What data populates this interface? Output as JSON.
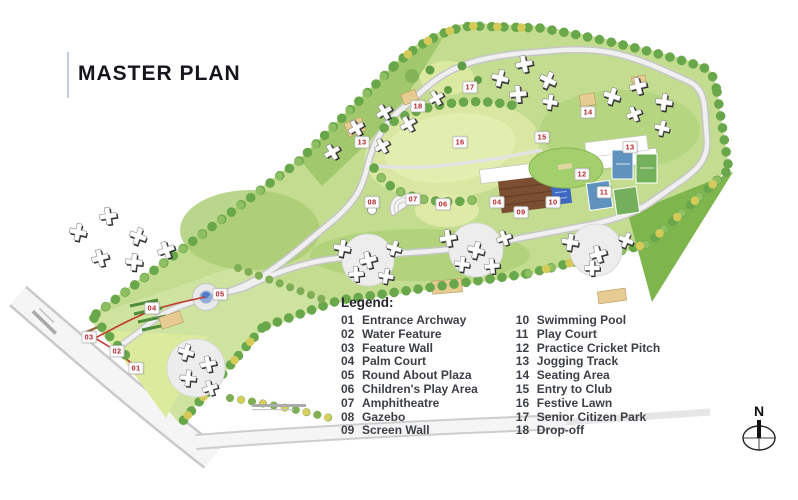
{
  "title": "MASTER PLAN",
  "legend": {
    "heading": "Legend:",
    "items": [
      {
        "num": "01",
        "label": "Entrance Archway"
      },
      {
        "num": "02",
        "label": "Water Feature"
      },
      {
        "num": "03",
        "label": "Feature Wall"
      },
      {
        "num": "04",
        "label": "Palm Court"
      },
      {
        "num": "05",
        "label": "Round About Plaza"
      },
      {
        "num": "06",
        "label": "Children's Play Area"
      },
      {
        "num": "07",
        "label": "Amphitheatre"
      },
      {
        "num": "08",
        "label": "Gazebo"
      },
      {
        "num": "09",
        "label": "Screen Wall"
      },
      {
        "num": "10",
        "label": "Swimming Pool"
      },
      {
        "num": "11",
        "label": "Play Court"
      },
      {
        "num": "12",
        "label": "Practice Cricket Pitch"
      },
      {
        "num": "13",
        "label": "Jogging Track"
      },
      {
        "num": "14",
        "label": "Seating Area"
      },
      {
        "num": "15",
        "label": "Entry to Club"
      },
      {
        "num": "16",
        "label": "Festive Lawn"
      },
      {
        "num": "17",
        "label": "Senior Citizen Park"
      },
      {
        "num": "18",
        "label": "Drop-off"
      }
    ]
  },
  "map": {
    "markers": [
      {
        "label": "01"
      },
      {
        "label": "02"
      },
      {
        "label": "03"
      },
      {
        "label": "04"
      },
      {
        "label": "05"
      },
      {
        "label": "06"
      },
      {
        "label": "07"
      },
      {
        "label": "08"
      },
      {
        "label": "09"
      },
      {
        "label": "10"
      },
      {
        "label": "11"
      },
      {
        "label": "12"
      },
      {
        "label": "13"
      },
      {
        "label": "14"
      },
      {
        "label": "15"
      },
      {
        "label": "16"
      },
      {
        "label": "17"
      },
      {
        "label": "18"
      },
      {
        "label": "13"
      },
      {
        "label": "04"
      }
    ]
  },
  "compass": {
    "north_label": "N"
  },
  "colors": {
    "marker_red": "#b3262c",
    "site_green": "#c3dc90",
    "lawn_yellow_green": "#dce9a6",
    "dark_lawn_green": "#7fb54d",
    "pool_blue": "#3f68c0",
    "road_grey": "#f0f0f0",
    "tree_green": "#69a74b",
    "tree_yellow": "#d4ca58",
    "plaza_tan": "#e6cb92"
  }
}
